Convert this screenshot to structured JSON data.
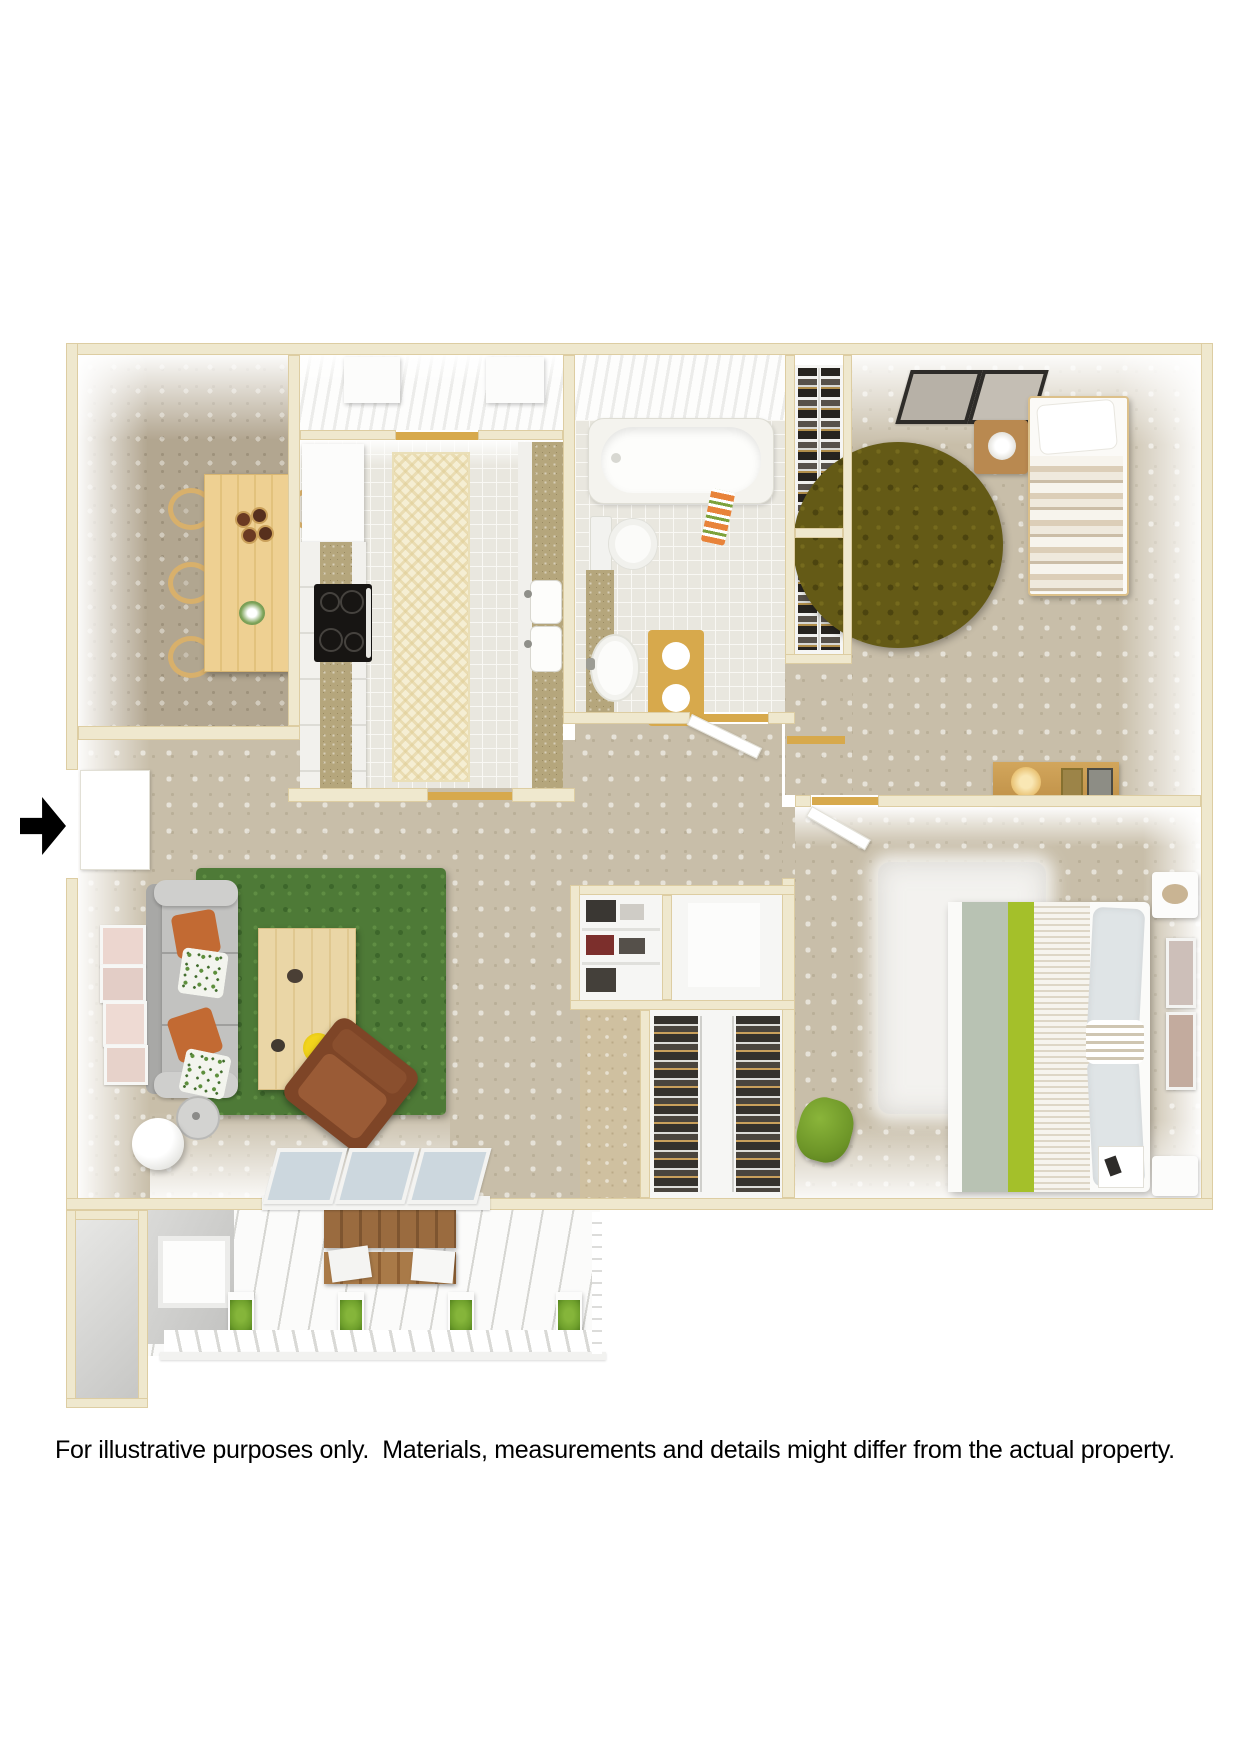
{
  "caption": {
    "text": "For illustrative purposes only.  Materials, measurements and details might differ from the actual property."
  },
  "floor_plan": {
    "kind": "3D top-down apartment floor plan rendering",
    "rooms_depicted": 10,
    "colors": {
      "page_bg": "#ffffff",
      "outer_wall_cream": "#efe8ce",
      "wall_edge": "#ddcda2",
      "carpet_tan": "#c8bea9",
      "carpet_dining": "#b2a690",
      "bath_tile": "#e9e7df",
      "kitchen_runner_cream": "#f5eed3",
      "countertop_tan": "#b5a67c",
      "dining_table_wood": "#eed092",
      "patio_bench_wood": "#9a6b3f",
      "living_rug_green": "#4e7a37",
      "bedroom_rug_olive": "#645a16",
      "master_rug_white": "#f3f2ef",
      "sofa_gray": "#c2c2c2",
      "armchair_brown": "#8a4b2c",
      "pillow_orange": "#c26a33",
      "bed_accent_green": "#a4c02a",
      "bed_blanket_sage": "#b8c2b3",
      "bath_mat_gold": "#d7a94c",
      "stove_black": "#171513",
      "glass_pane_blue": "#ccd7de",
      "planter_green": "#6fa02c",
      "entry_arrow_black": "#000000"
    },
    "icons": {
      "entry_arrow": "right-pointing solid black arrow marking unit entry door"
    }
  }
}
